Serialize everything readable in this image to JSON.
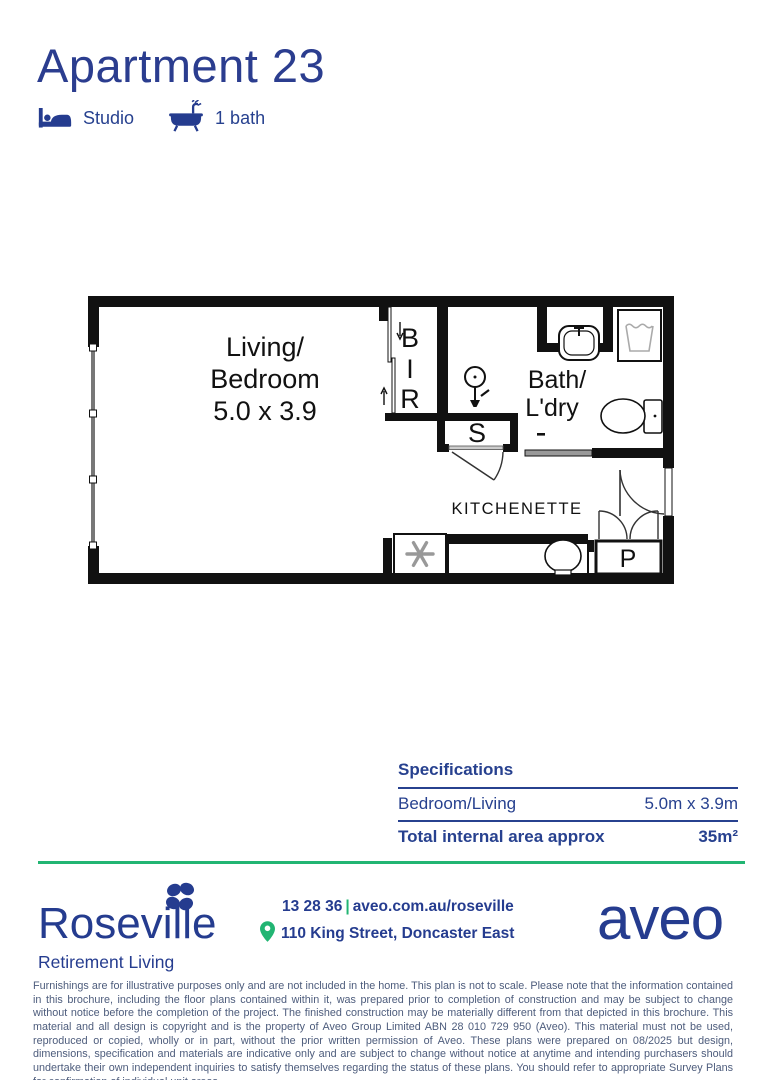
{
  "colors": {
    "navy": "#27418f",
    "teal": "#22b573",
    "wall_black": "#111111",
    "disclaimer_text": "#4d5c7c"
  },
  "header": {
    "title": "Apartment 23",
    "features": [
      {
        "icon": "bed-icon",
        "label": "Studio"
      },
      {
        "icon": "bath-icon",
        "label": "1 bath"
      }
    ]
  },
  "plan": {
    "labels": {
      "living_line1": "Living/",
      "living_line2": "Bedroom",
      "living_line3": "5.0 x 3.9",
      "bir": [
        "B",
        "I",
        "R"
      ],
      "bath_line1": "Bath/",
      "bath_line2": "L'dry",
      "shower": "S",
      "kitchenette": "KITCHENETTE",
      "pantry": "P"
    }
  },
  "specs": {
    "title": "Specifications",
    "rows": [
      {
        "label": "Bedroom/Living",
        "value": "5.0m x 3.9m"
      },
      {
        "label": "Total internal area approx",
        "value": "35m²"
      }
    ]
  },
  "footer": {
    "community_name": "Roseville",
    "community_tagline": "Retirement Living",
    "phone": "13 28 36",
    "separator": "|",
    "website": "aveo.com.au/roseville",
    "address": "110 King Street, Doncaster East",
    "brand": "aveo"
  },
  "disclaimer": "Furnishings are for illustrative purposes only and are not included in the home. This plan is not to scale. Please note that the information contained in this brochure, including the floor plans contained within it, was prepared prior to completion of construction and may be subject to change without notice before the completion of the project. The finished construction may be materially different from that depicted in this brochure. This material and all design is copyright and is the property of Aveo Group Limited ABN 28 010 729 950 (Aveo). This material must not be used, reproduced or copied, wholly or in part, without the prior written permission of Aveo. These plans were prepared on 08/2025 but design, dimensions, specification and materials are indicative only and are subject to change without notice at anytime and intending purchasers should undertake their own independent inquiries to satisfy themselves regarding the status of these plans. You should refer to appropriate Survey Plans for confirmation of individual unit areas."
}
